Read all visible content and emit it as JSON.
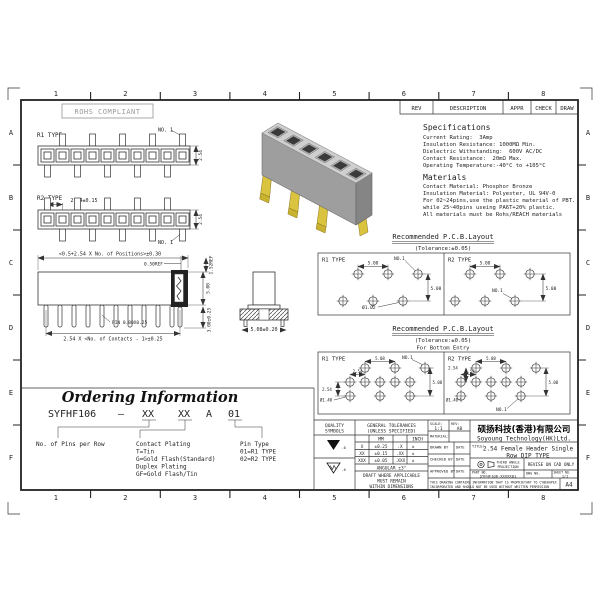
{
  "frame": {
    "cols": [
      "1",
      "2",
      "3",
      "4",
      "5",
      "6",
      "7",
      "8"
    ],
    "rows": [
      "A",
      "B",
      "C",
      "D",
      "E",
      "F"
    ]
  },
  "rohs_label": "ROHS COMPLIANT",
  "rev_table": {
    "rev": "REV",
    "description": "DESCRIPTION",
    "appr": "APPR",
    "check": "CHECK",
    "draw": "DRAW"
  },
  "front_views": {
    "r1_label": "R1 TYPE",
    "r2_label": "R2 TYPE",
    "no1": "NO. 1",
    "pitch_v": "2.54",
    "r2_pitch_dim": "2.54±0.15"
  },
  "specs": {
    "title": "Specifications",
    "lines": [
      "Current Rating:  3Amp",
      "Insulation Resistance: 1000MΩ Min.",
      "Dielectric Withstanding:  600V AC/DC",
      "Contact Resistance:  20mΩ Max.",
      "Operating Temperature:-40°C to +105°C"
    ]
  },
  "materials": {
    "title": "Materials",
    "lines": [
      "Contact Material: Phosphor Bronze",
      "Insulation Material: Polyester, UL 94V-0",
      "For 02~24pins,use the plastic material of PBT.",
      "while 25~40pins useing PA6T+20% plastic.",
      "All materials must be Rohs/REACH materials"
    ]
  },
  "side_view": {
    "dim_top": "<0.5+2.54 X No. of Positions>±0.30",
    "dim_050": "0.50REF",
    "dim_152": "1.52REF",
    "dim_500": "5.00",
    "dim_pin": "PIN 0.80X0.25",
    "dim_bottom": "2.54 X <No. of Contacts - 1>±0.25",
    "dim_300": "3.00±0.25",
    "dim_508": "5.08±0.20"
  },
  "pcb_top": {
    "title": "Recommended P.C.B.Layout",
    "tol": "(Tolerance:±0.05)",
    "r1": "R1 TYPE",
    "r2": "R2 TYPE",
    "no1": "NO.1",
    "dim_h": "5.08",
    "dim_v": "5.08",
    "hole": "Ø1.02"
  },
  "pcb_bottom": {
    "title": "Recommended P.C.B.Layout",
    "tol": "(Tolerance:±0.05)",
    "subtitle": "For Bottom Entry",
    "r1": "R1 TYPE",
    "r2": "R2 TYPE",
    "no1": "NO.1",
    "dim_h": "5.08",
    "dim_254": "2.54",
    "dim_v": "5.08",
    "hole": "Ø1.40"
  },
  "ordering": {
    "title": "Ordering Information",
    "base": "SYFHF106",
    "dash": "–",
    "xx1": "XX",
    "xx2": "XX",
    "a": "A",
    "suffix": "01",
    "pins_label": "No. of Pins per Row",
    "plating_lines": [
      "Contact Plating",
      "T=Tin",
      "G=Gold Flash(Standard)",
      "Duplex Plating",
      "GF=Gold Flash/Tin"
    ],
    "pintype_lines": [
      "Pin Type",
      "01=R1 TYPE",
      "02=R2 TYPE"
    ]
  },
  "title_block": {
    "quality1": "QUALITY",
    "quality2": "SYMBOLS",
    "sym1_note": "-0",
    "sym2_note": "-0",
    "tol1": "GENERAL TOLERANCES",
    "tol2": "(UNLESS SPECIFIED)",
    "mm": "MM",
    "inch": "INCH",
    "rows": [
      [
        "X",
        "±0.25",
        ".X",
        "±"
      ],
      [
        "XX",
        "±0.15",
        ".XX",
        "±"
      ],
      [
        "XXX",
        "±0.05",
        ".XXX",
        "±"
      ]
    ],
    "angular": "ANGULAR ±3°",
    "draft1": "DRAFT WHERE APPLICABLE",
    "draft2": "MUST REMAIN",
    "draft3": "WITHIN DIMENSIONS",
    "scale_label": "SCALE:",
    "scale": "1:1",
    "rev_label": "REV:",
    "rev": "A0",
    "material_label": "MATERIAL:",
    "drawn": "DRAWN BY",
    "checked": "CHECKED BY",
    "approved": "APPROVED BY",
    "date": "DATE",
    "company_cn": "硕扬科技(香港)有限公司",
    "company_en": "Soyoung Technology(HK)Ltd.",
    "title_label": "TITLE:",
    "title_line1": "2.54 Female Header Single",
    "title_line2": "Row DIP TYPE",
    "third_angle1": "THIRD ANGLE",
    "third_angle2": "PROJECTION",
    "revise": "REVISE ON CAD ONLY",
    "part_label": "PART NO.",
    "part_no": "SYFHF106-XXXXX01",
    "dwg_label": "DWG NO.",
    "sheet_label": "SHEET NO.",
    "sheet": "1/1",
    "prop1": "THIS DRAWING CONTAINS INFORMATION THAT IS PROPRIETARY TO CYBERAPEX",
    "prop2": "INCORPORATED AND SHOULD NOT BE USED WITHOUT WRITTEN PERMISSION",
    "size": "A4"
  }
}
